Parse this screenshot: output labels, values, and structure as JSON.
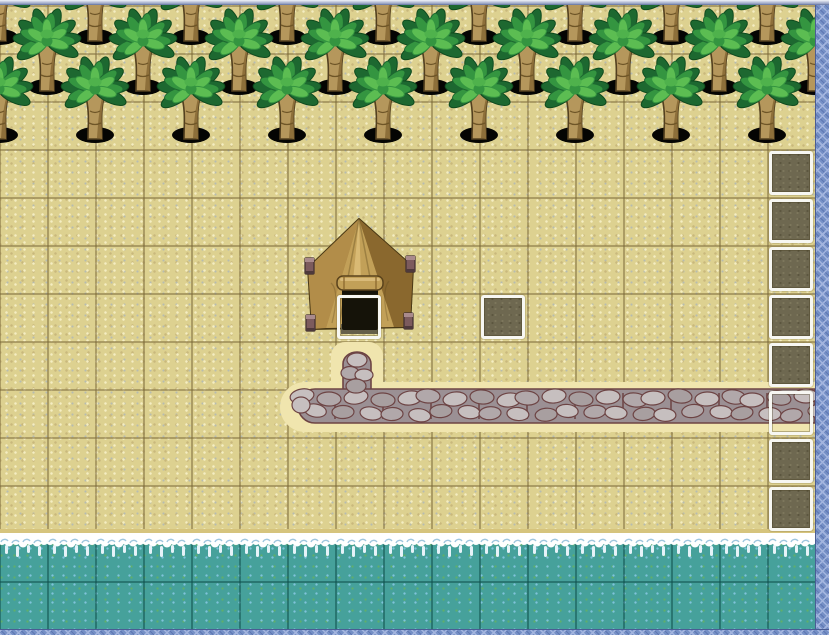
{
  "app": {
    "context": "rpg-map-editor-canvas",
    "visible_text": []
  },
  "map": {
    "tile_size": 48,
    "cols": 17,
    "rows": 13,
    "origin": {
      "x": -1,
      "y": 5
    },
    "canvas": {
      "width": 815,
      "height": 624
    },
    "viewport": {
      "width": 829,
      "height": 635
    },
    "water_top": 528,
    "palms": {
      "sprite": "palm-tree",
      "rows": [
        {
          "base_y": 32,
          "first_x": -1,
          "step": 96,
          "count": 9
        },
        {
          "base_y": 82,
          "first_x": 47,
          "step": 96,
          "count": 9
        },
        {
          "base_y": 130,
          "first_x": -1,
          "step": 96,
          "count": 9
        }
      ]
    },
    "tent": {
      "sprite": "tent",
      "x": 303,
      "y": 212,
      "width": 114,
      "height": 118
    },
    "path": {
      "sprite": "cobblestone-path",
      "horizontal": {
        "x_start": 298,
        "x_end": 815,
        "top": 384,
        "height": 34
      },
      "stub": {
        "center_x": 357,
        "top": 347,
        "width": 28,
        "bottom": 392
      }
    },
    "shoreline": {
      "sprite": "surf-foam",
      "y": 528,
      "tiles": 18
    },
    "events": [
      {
        "col": 7,
        "row": 6,
        "surface": "tent-door"
      },
      {
        "col": 10,
        "row": 6,
        "surface": "dirt"
      },
      {
        "col": 16,
        "row": 3,
        "surface": "dirt"
      },
      {
        "col": 16,
        "row": 4,
        "surface": "dirt"
      },
      {
        "col": 16,
        "row": 5,
        "surface": "dirt"
      },
      {
        "col": 16,
        "row": 6,
        "surface": "dirt"
      },
      {
        "col": 16,
        "row": 7,
        "surface": "dirt"
      },
      {
        "col": 16,
        "row": 8,
        "surface": "path"
      },
      {
        "col": 16,
        "row": 9,
        "surface": "dirt"
      },
      {
        "col": 16,
        "row": 10,
        "surface": "dirt"
      }
    ],
    "borders": {
      "right_width": 14,
      "bottom_height": 6,
      "top_bar_height": 5
    },
    "colors": {
      "sand": "#ddd190",
      "sand_speckle_light": "#f4edc2",
      "sand_speckle_dark": "#c9b87c",
      "sand_speckle_gray": "#b7bcb0",
      "grid_sand": "rgba(122,103,55,0.5)",
      "grid_water": "rgba(16,82,78,0.55)",
      "water": "#46a19b",
      "water_speckle_blue": "#7fc3da",
      "water_speckle_green": "#5fae6c",
      "foam": "#ffffff",
      "foam_shadow": "#9fc6de",
      "foam_drip": "#e6f3f9",
      "wet_sand": "#d6c47d",
      "halo": "#f0e5ae",
      "path_bg": "#9b9094",
      "stone_light": "#c6bfbf",
      "stone_mid": "#b1a8aa",
      "stone_dark": "#a89fa0",
      "mortar": "#6d4444",
      "event_border": "#f7f7f2",
      "event_dirt": "#6e6850",
      "event_dirt_dot_light": "#7d775c",
      "event_dirt_dot_dark": "#5c563f",
      "outside_base": "#7590c6",
      "outside_lattice": "#a2b4de",
      "outside_shade": "#5f77b2",
      "topbar_from": "#f2f4f8",
      "topbar_to": "#8c98bc",
      "tree_trunk": "#b5975c",
      "tree_trunk_shade": "#8d6f3a",
      "tree_trunk_line": "#53401f",
      "tree_hole": "#050503",
      "tree_frond_dark": "#1d6830",
      "tree_frond_mid": "#349540",
      "tree_frond_light": "#5cbd52",
      "tree_frond_outline": "#0f4a1e",
      "tent_base": "#ab8440",
      "tent_front": "#c2a058",
      "tent_right": "#8a682e",
      "tent_left": "#b28d49",
      "tent_ridge": "#dcbd78",
      "tent_outline": "#493814",
      "tent_door": "#151309",
      "tent_dirt": "#655f49",
      "tent_pole": "#7c5b5d",
      "tent_pole_cap": "#a98a8c",
      "tent_pole_line": "#3e2d2f"
    }
  }
}
